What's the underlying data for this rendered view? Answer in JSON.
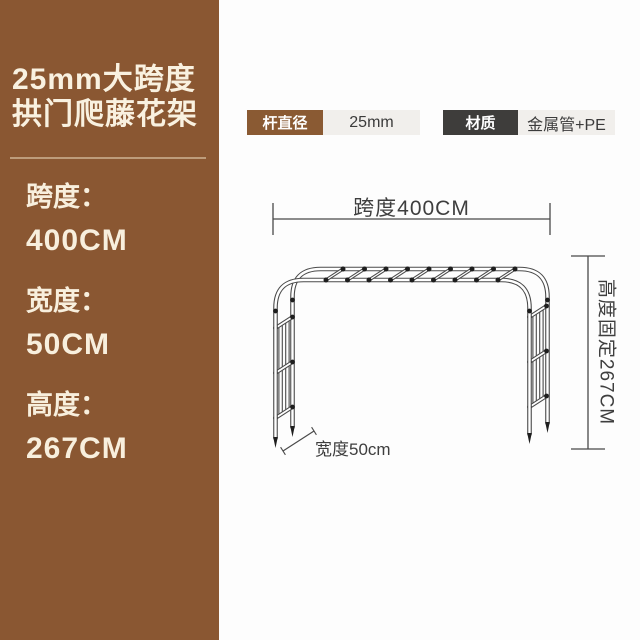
{
  "sidebar": {
    "title_line1": "25mm大跨度",
    "title_line2": "拱门爬藤花架",
    "specs": [
      {
        "label": "跨度：",
        "value": "400CM"
      },
      {
        "label": "宽度：",
        "value": "50CM"
      },
      {
        "label": "高度：",
        "value": "267CM"
      }
    ],
    "background_color": "#8a5732",
    "text_color": "#f8efdd"
  },
  "badges": [
    {
      "label": "杆直径",
      "value": "25mm",
      "label_bg": "#8a5a33",
      "value_bg": "#f1efec"
    },
    {
      "label": "材质",
      "value": "金属管+PE",
      "label_bg": "#3e3d3b",
      "value_bg": "#f1efec"
    }
  ],
  "diagram": {
    "span_label": "跨度400CM",
    "height_label": "高度固定267CM",
    "width_label": "宽度50cm",
    "line_color": "#4a4a4a",
    "text_color": "#3e3e3e"
  }
}
